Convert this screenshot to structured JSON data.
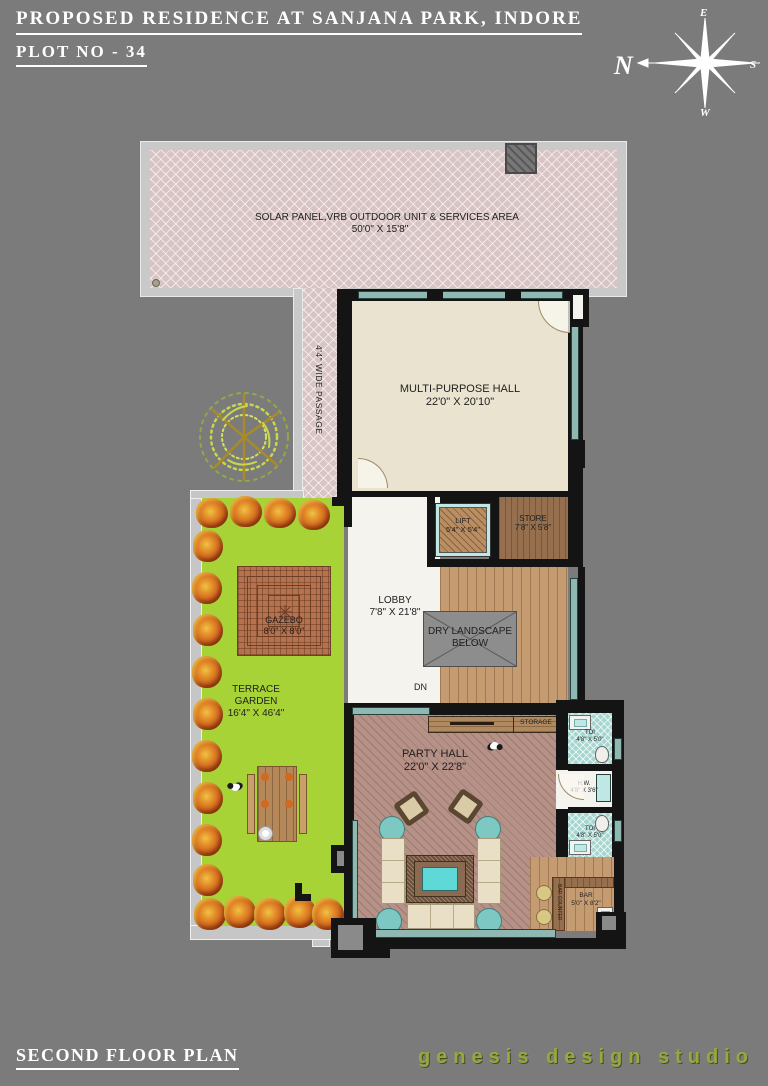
{
  "header": {
    "title": "PROPOSED RESIDENCE AT SANJANA PARK, INDORE",
    "plot": "PLOT NO - 34"
  },
  "compass": {
    "n": "N",
    "e": "E",
    "s": "S",
    "w": "W"
  },
  "rooms": {
    "solar": {
      "name": "SOLAR PANEL,VRB OUTDOOR UNIT & SERVICES AREA",
      "size": "50'0\" X 15'8\""
    },
    "passage": {
      "name": "4'4\" WIDE PASSAGE"
    },
    "hall": {
      "name": "MULTI-PURPOSE HALL",
      "size": "22'0\" X 20'10\""
    },
    "lift": {
      "name": "LIFT",
      "size": "5'4\" X 5'4\""
    },
    "store": {
      "name": "STORE",
      "size": "7'8\" X 5'8\""
    },
    "lobby": {
      "name": "LOBBY",
      "size": "7'8\" X 21'8\""
    },
    "dry": {
      "line1": "DRY LANDSCAPE",
      "line2": "BELOW"
    },
    "dn": "DN",
    "gazebo": {
      "name": "GAZEBO",
      "size": "8'0\" X 8'0\""
    },
    "garden": {
      "line1": "TERRACE",
      "line2": "GARDEN",
      "size": "16'4\" X 46'4\""
    },
    "party": {
      "name": "PARTY HALL",
      "size": "22'0\" X 22'8\""
    },
    "storage": "STORAGE",
    "toi_top": {
      "name": "TOI",
      "size": "4'8\" X 5'0\""
    },
    "hw": {
      "name": "H.W.",
      "size": "4'8\" X 3'6\""
    },
    "toi_bottom": {
      "name": "TOI",
      "size": "4'8\" X 5'0\""
    },
    "bar": {
      "name": "BAR",
      "size": "5'0\" X 8'2\""
    },
    "bar_counter": "BAR COUNTER"
  },
  "footer": {
    "plan": "SECOND FLOOR PLAN",
    "studio": "genesis design studio"
  },
  "colors": {
    "background": "#7b7b7b",
    "garden_green": "#a7d337",
    "solar_pink": "#d9c4c4",
    "window_teal": "#8fb8b2",
    "party_floor": "#b69187",
    "studio_text": "#97a83e"
  }
}
